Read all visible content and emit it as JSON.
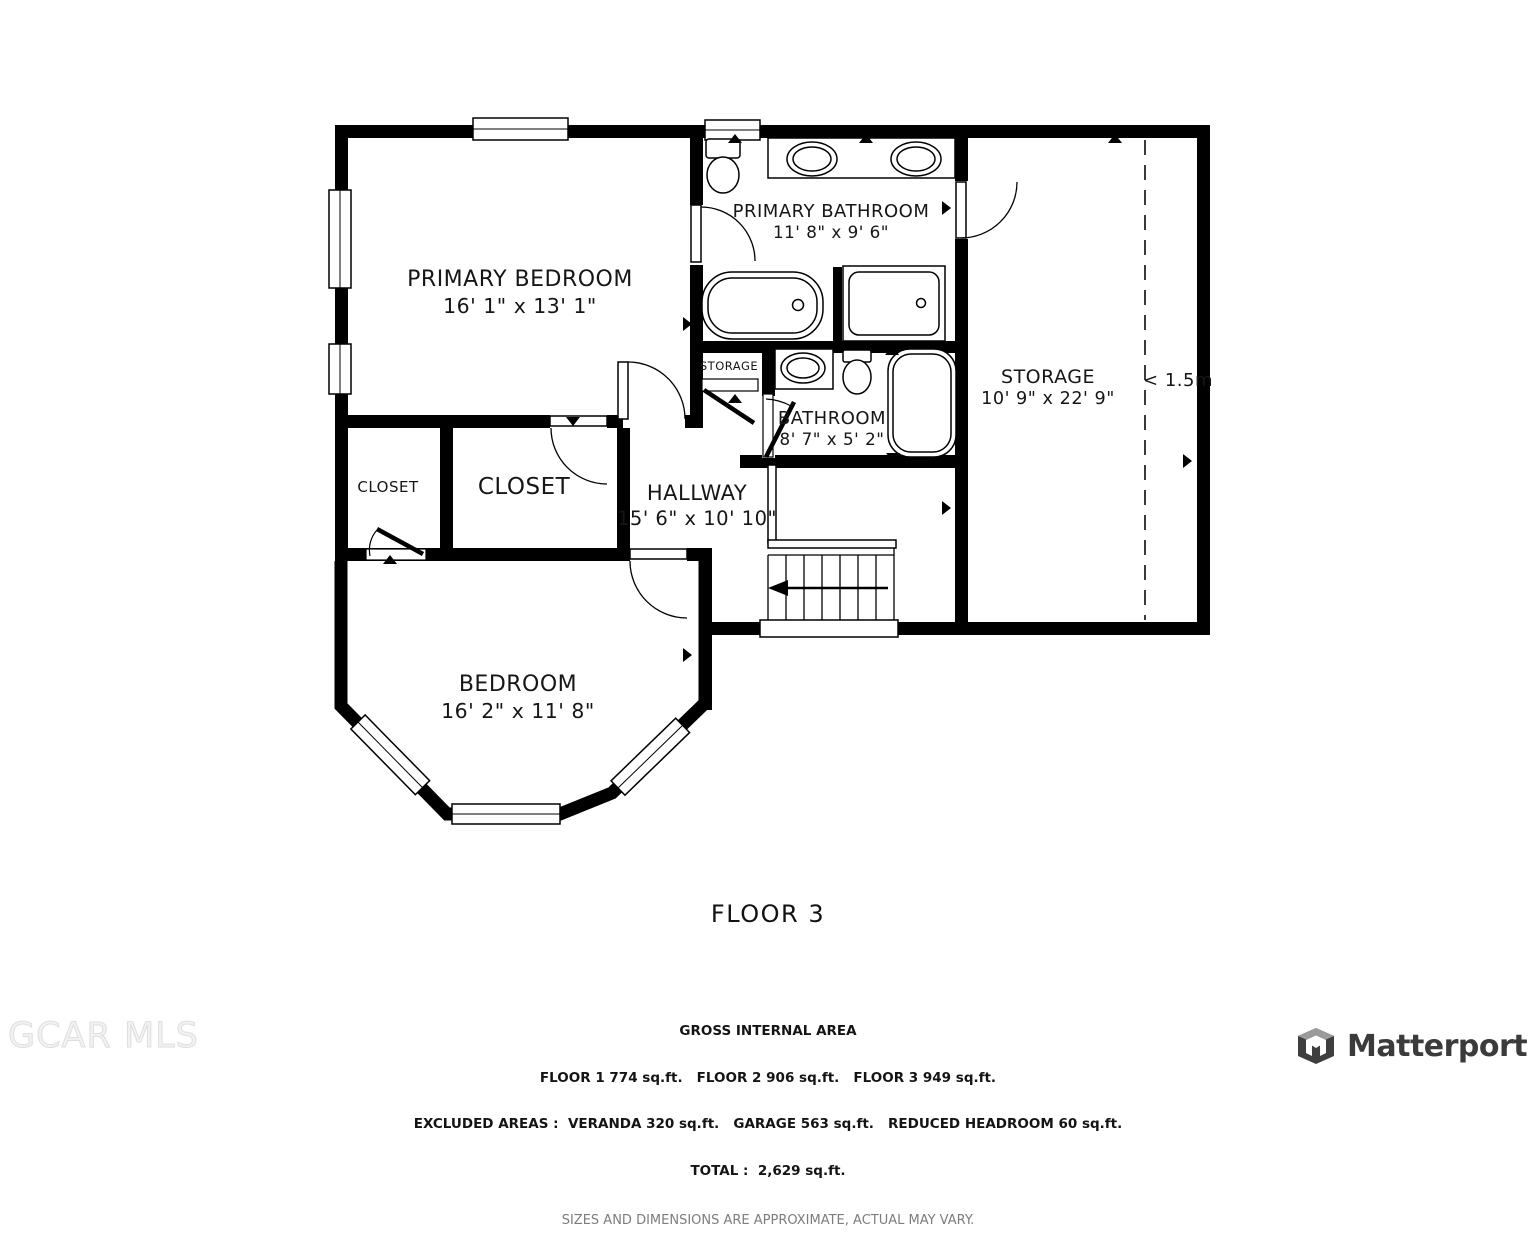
{
  "title": "FLOOR 3",
  "rooms": {
    "primary_bedroom": {
      "name": "PRIMARY BEDROOM",
      "dims": "16' 1\" x 13' 1\""
    },
    "primary_bathroom": {
      "name": "PRIMARY BATHROOM",
      "dims": "11' 8\" x 9' 6\""
    },
    "storage": {
      "name": "STORAGE",
      "dims": "10' 9\" x 22' 9\""
    },
    "bathroom": {
      "name": "BATHROOM",
      "dims": "8' 7\" x 5' 2\""
    },
    "hallway": {
      "name": "HALLWAY",
      "dims": "15' 6\" x 10' 10\""
    },
    "bedroom": {
      "name": "BEDROOM",
      "dims": "16' 2\" x 11' 8\""
    },
    "closet_small": {
      "name": "CLOSET"
    },
    "closet_large": {
      "name": "CLOSET"
    },
    "storage_closet": {
      "name": "STORAGE"
    }
  },
  "annotations": {
    "headroom": "< 1.5m"
  },
  "footer": {
    "gross_title": "GROSS INTERNAL AREA",
    "floors_line": "FLOOR 1 774 sq.ft.   FLOOR 2 906 sq.ft.   FLOOR 3 949 sq.ft.",
    "excluded_line": "EXCLUDED AREAS :  VERANDA 320 sq.ft.   GARAGE 563 sq.ft.   REDUCED HEADROOM 60 sq.ft.",
    "total_line": "TOTAL :  2,629 sq.ft.",
    "disclaimer": "SIZES AND DIMENSIONS ARE APPROXIMATE, ACTUAL MAY VARY."
  },
  "watermarks": {
    "mls": "GCAR MLS",
    "brand": "Matterport"
  }
}
